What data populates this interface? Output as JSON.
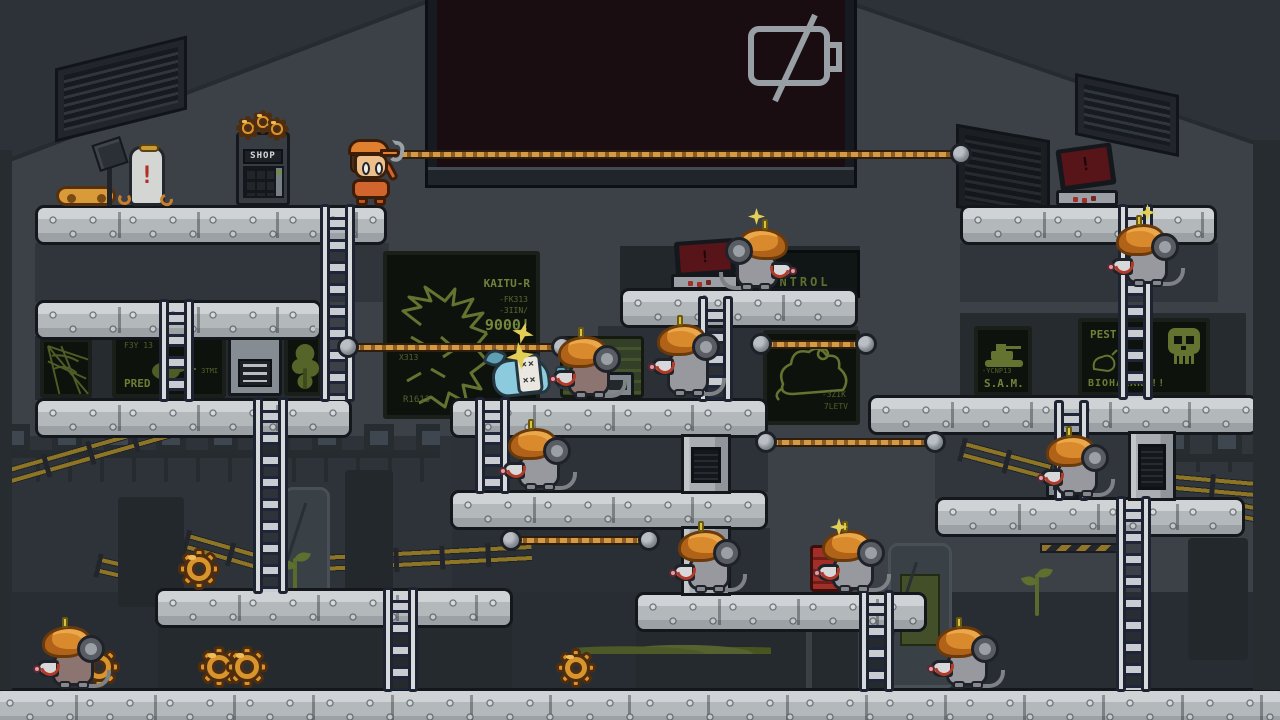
{
  "viewport": {
    "width": 1280,
    "height": 720
  },
  "palette": {
    "wall": "#3c4147",
    "platform": "#b3b8bb",
    "accent_orange": "#d9952d",
    "rope": "#d79a44",
    "screen_green": "#71813a",
    "alert_red": "#571419",
    "mouse_gray": "#97999e",
    "hat_orange": "#d98a2c",
    "caution_yellow": "#8e7526",
    "big_screen_bg": "#190d12",
    "battery_icon": "#98a0a6"
  },
  "hud": {
    "screen_icon": "battery-empty"
  },
  "shop": {
    "label": "SHOP"
  },
  "alerts": {
    "exclamation": "!"
  },
  "ko": {
    "tag_row": "××"
  },
  "monitors": {
    "kaiju": {
      "title": "KAITU-R",
      "line1": "-FK313",
      "line2": "-3IIN/",
      "score": "9000!",
      "side": "X313",
      "foot": "R1613"
    },
    "control": {
      "label": "CONTROL"
    },
    "predator": {
      "head": "F3Y 13",
      "label": "PRED",
      "side": "3TMI"
    },
    "sam": {
      "sub": "-YCNP13",
      "label": "S.A.M."
    },
    "pest": {
      "title": "PEST!",
      "bottom": "BIOHAZARD!!"
    },
    "rat": {
      "g1": "-3ZIK",
      "g2": "7LETV"
    }
  },
  "scene": {
    "bgrects": [
      {
        "x": 35,
        "y": 243,
        "w": 354,
        "h": 59,
        "c": "#30353b"
      },
      {
        "x": 960,
        "y": 243,
        "w": 258,
        "h": 59,
        "c": "#30353b"
      },
      {
        "x": 35,
        "y": 336,
        "w": 287,
        "h": 64,
        "c": "#262b30"
      },
      {
        "x": 960,
        "y": 313,
        "w": 286,
        "h": 84,
        "c": "#262b30"
      },
      {
        "x": 620,
        "y": 246,
        "w": 240,
        "h": 48,
        "c": "#22272c"
      },
      {
        "x": 598,
        "y": 326,
        "w": 260,
        "h": 72,
        "c": "#2b3036"
      },
      {
        "x": 450,
        "y": 436,
        "w": 318,
        "h": 56,
        "c": "#2d3238"
      },
      {
        "x": 450,
        "y": 528,
        "w": 320,
        "h": 66,
        "c": "#2a2f35"
      },
      {
        "x": 935,
        "y": 433,
        "w": 323,
        "h": 66,
        "c": "#31363c"
      },
      {
        "x": 0,
        "y": 436,
        "w": 452,
        "h": 156,
        "c": "#2e333a"
      },
      {
        "x": 0,
        "y": 592,
        "w": 1280,
        "h": 96,
        "c": "#282d33"
      },
      {
        "x": 158,
        "y": 626,
        "w": 354,
        "h": 62,
        "c": "#252a2f"
      },
      {
        "x": 636,
        "y": 630,
        "w": 290,
        "h": 58,
        "c": "#252a2f"
      }
    ],
    "desk_rows": [
      {
        "x": 0,
        "y": 424,
        "w": 440,
        "h": 58
      },
      {
        "x": 1160,
        "y": 428,
        "w": 120,
        "h": 44
      }
    ],
    "fences": [
      {
        "x": 0,
        "y": 470,
        "w": 258,
        "r": -16
      },
      {
        "x": 96,
        "y": 556,
        "w": 88,
        "r": 13
      },
      {
        "x": 184,
        "y": 532,
        "w": 74,
        "r": 16
      },
      {
        "x": 302,
        "y": 556,
        "w": 230,
        "r": -3
      },
      {
        "x": 960,
        "y": 440,
        "w": 94,
        "r": 15
      },
      {
        "x": 1164,
        "y": 473,
        "w": 118,
        "r": 5
      },
      {
        "x": 1228,
        "y": 500,
        "w": 58,
        "r": 11
      }
    ],
    "hazards": [
      {
        "x": 1044,
        "y": 526,
        "w": 80
      },
      {
        "x": 1040,
        "y": 543,
        "w": 86
      }
    ],
    "pods": [
      {
        "x": 283,
        "y": 487,
        "w": 47,
        "h": 120,
        "v": "tube"
      },
      {
        "x": 118,
        "y": 497,
        "w": 66,
        "h": 110,
        "v": "col"
      },
      {
        "x": 345,
        "y": 470,
        "w": 48,
        "h": 137,
        "v": "col"
      },
      {
        "x": 888,
        "y": 543,
        "w": 64,
        "h": 145,
        "v": "tube",
        "win": true
      },
      {
        "x": 1188,
        "y": 538,
        "w": 60,
        "h": 122,
        "v": "col"
      },
      {
        "x": 806,
        "y": 626,
        "w": 58,
        "h": 62,
        "v": "frame"
      }
    ],
    "moss": [
      {
        "x": 575,
        "y": 640,
        "w": 196,
        "h": 14
      }
    ],
    "sprouts": [
      {
        "x": 282,
        "y": 552
      },
      {
        "x": 1024,
        "y": 568
      }
    ],
    "platforms": [
      {
        "x": 35,
        "y": 205,
        "w": 352
      },
      {
        "x": 960,
        "y": 205,
        "w": 257
      },
      {
        "x": 620,
        "y": 288,
        "w": 238
      },
      {
        "x": 35,
        "y": 300,
        "w": 287
      },
      {
        "x": 35,
        "y": 398,
        "w": 317
      },
      {
        "x": 450,
        "y": 398,
        "w": 318
      },
      {
        "x": 868,
        "y": 395,
        "w": 390
      },
      {
        "x": 450,
        "y": 490,
        "w": 318
      },
      {
        "x": 935,
        "y": 497,
        "w": 310
      },
      {
        "x": 155,
        "y": 588,
        "w": 358
      },
      {
        "x": 635,
        "y": 592,
        "w": 292
      },
      {
        "x": -8,
        "y": 688,
        "w": 1296,
        "h": 40
      }
    ],
    "ducts": [
      {
        "x": 681,
        "y": 434,
        "w": 50,
        "h": 60
      },
      {
        "x": 681,
        "y": 526,
        "w": 50,
        "h": 70
      },
      {
        "x": 1128,
        "y": 431,
        "w": 48,
        "h": 70
      }
    ],
    "ladders": [
      {
        "x": 322,
        "y": 208,
        "h": 192
      },
      {
        "x": 161,
        "y": 303,
        "h": 97
      },
      {
        "x": 255,
        "y": 401,
        "h": 191
      },
      {
        "x": 477,
        "y": 401,
        "h": 91
      },
      {
        "x": 700,
        "y": 300,
        "h": 100
      },
      {
        "x": 1120,
        "y": 208,
        "h": 190
      },
      {
        "x": 1118,
        "y": 500,
        "h": 190
      },
      {
        "x": 385,
        "y": 591,
        "h": 99
      },
      {
        "x": 861,
        "y": 594,
        "h": 96
      },
      {
        "x": 1056,
        "y": 404,
        "h": 95
      }
    ],
    "ropes": [
      {
        "x": 398,
        "y": 150,
        "len": 560,
        "la": false
      },
      {
        "x": 351,
        "y": 343,
        "len": 208,
        "la": true
      },
      {
        "x": 764,
        "y": 340,
        "len": 99,
        "la": true
      },
      {
        "x": 769,
        "y": 438,
        "len": 163,
        "la": true
      },
      {
        "x": 514,
        "y": 536,
        "len": 132,
        "la": true
      }
    ],
    "gears": [
      {
        "x": 178,
        "y": 548,
        "s": 42
      },
      {
        "x": 78,
        "y": 646,
        "s": 42
      },
      {
        "x": 198,
        "y": 646,
        "s": 42
      },
      {
        "x": 226,
        "y": 646,
        "s": 42
      },
      {
        "x": 556,
        "y": 648,
        "s": 40
      },
      {
        "x": 236,
        "y": 116,
        "s": 24
      },
      {
        "x": 251,
        "y": 110,
        "s": 24
      },
      {
        "x": 265,
        "y": 117,
        "s": 24
      }
    ],
    "mice": [
      {
        "x": 728,
        "y": 234,
        "f": false,
        "c": "gray",
        "s": true
      },
      {
        "x": 556,
        "y": 342,
        "f": true,
        "c": "brown"
      },
      {
        "x": 655,
        "y": 330,
        "f": true,
        "c": "gray",
        "t": true
      },
      {
        "x": 506,
        "y": 434,
        "f": true,
        "c": "gray"
      },
      {
        "x": 1114,
        "y": 230,
        "f": true,
        "c": "gray",
        "s": true
      },
      {
        "x": 676,
        "y": 536,
        "f": true,
        "c": "gray"
      },
      {
        "x": 820,
        "y": 536,
        "f": true,
        "c": "gray"
      },
      {
        "x": 1044,
        "y": 441,
        "f": true,
        "c": "gray"
      },
      {
        "x": 40,
        "y": 632,
        "f": true,
        "c": "brown"
      },
      {
        "x": 934,
        "y": 632,
        "f": true,
        "c": "gray"
      }
    ],
    "sparks": [
      {
        "x": 830,
        "y": 518
      }
    ]
  }
}
